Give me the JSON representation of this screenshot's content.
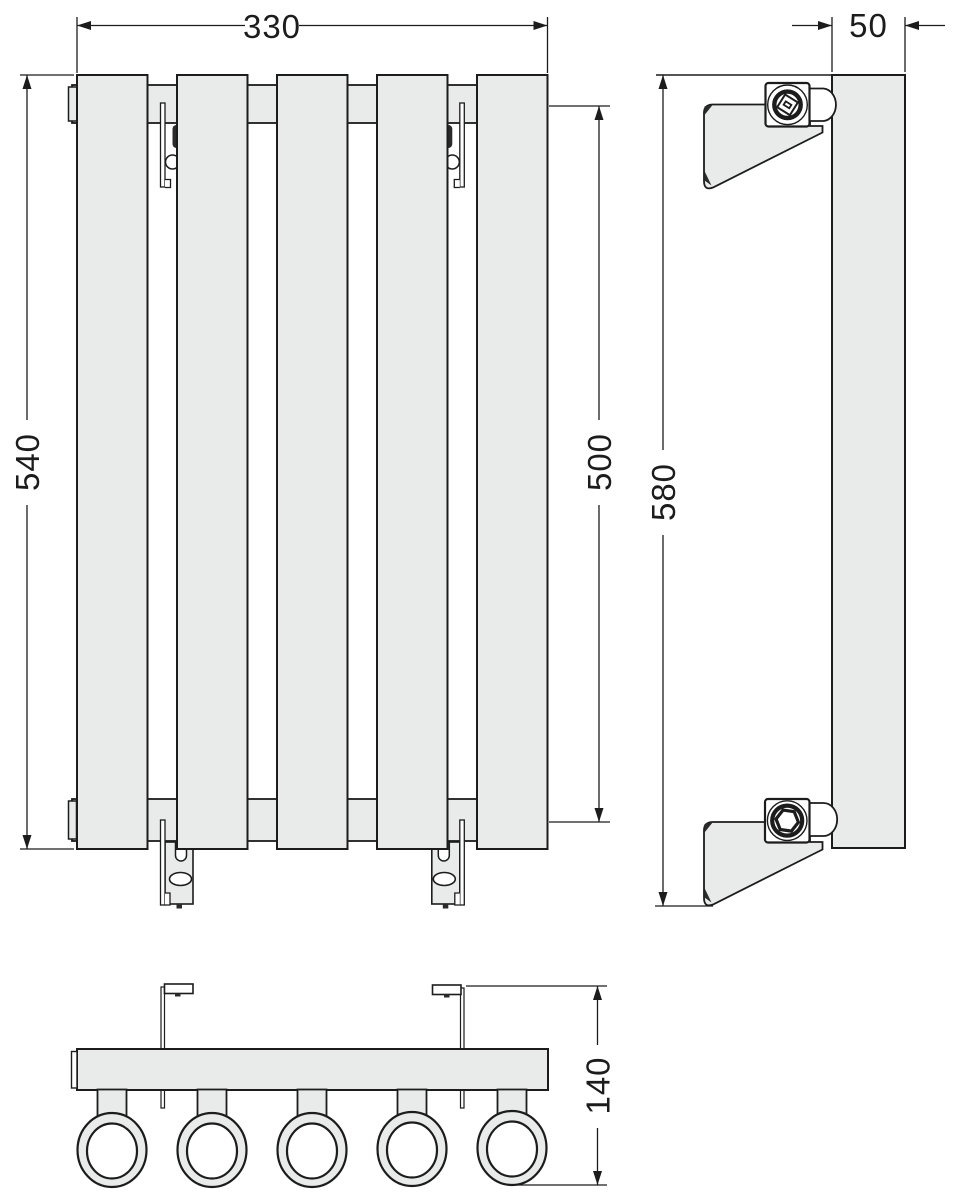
{
  "drawing": {
    "type": "radiator-technical-drawing",
    "panel_count": 5,
    "views": {
      "front": {
        "width": "330",
        "height": "540",
        "connection_spacing": "500"
      },
      "side": {
        "depth": "50",
        "height": "580"
      },
      "bottom": {
        "overall_depth": "140"
      }
    },
    "colors": {
      "outline": "#1c1c1c",
      "fill": "#e9eaea",
      "background": "#ffffff"
    }
  }
}
